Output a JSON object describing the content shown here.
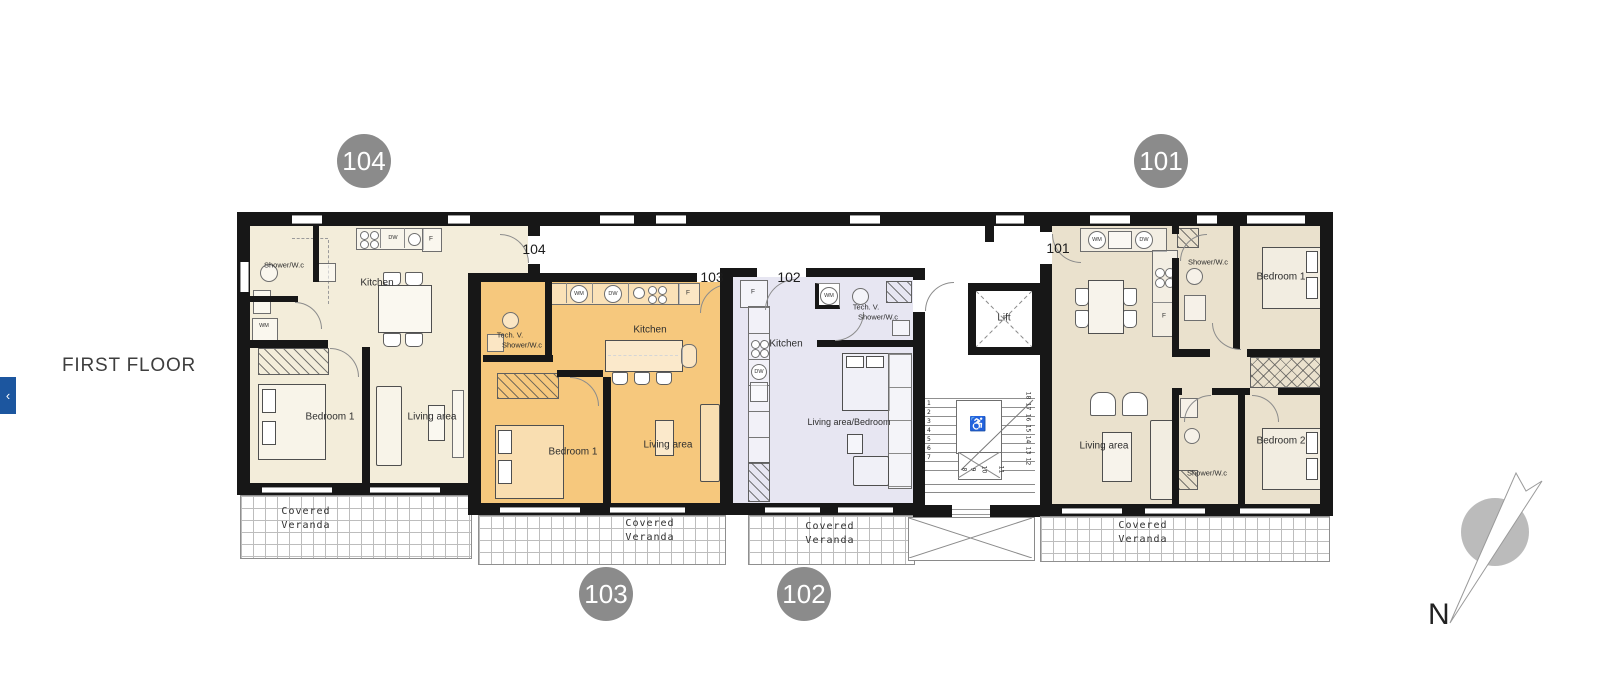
{
  "header": {
    "floor_title": "FIRST FLOOR"
  },
  "nav": {
    "back_chevron": "‹"
  },
  "badges": {
    "apt104": "104",
    "apt101": "101",
    "apt103": "103",
    "apt102": "102"
  },
  "compass": {
    "north_label": "N"
  },
  "colors": {
    "apt104_fill": "#f3edda",
    "apt103_fill": "#f6c87d",
    "apt102_fill": "#e7e6f2",
    "apt101_fill": "#eae1cd",
    "badge_gray": "#8b8b8b",
    "accent_blue": "#1c569f",
    "wall_black": "#171717",
    "compass_gray": "#b4b4b4"
  },
  "apt104": {
    "door_label": "104",
    "shower_wc": "Shower/W.c",
    "wm": "WM",
    "kitchen": "Kitchen",
    "dw": "DW",
    "fridge": "F",
    "bedroom1": "Bedroom 1",
    "living": "Living area",
    "veranda_line1": "Covered",
    "veranda_line2": "Veranda"
  },
  "apt103": {
    "corner_label": "103",
    "tech": "Tech. V.",
    "shower_wc": "Shower/W.c",
    "wm": "WM",
    "dw": "DW",
    "fridge": "F",
    "kitchen": "Kitchen",
    "bedroom1": "Bedroom 1",
    "living": "Living area",
    "veranda_line1": "Covered",
    "veranda_line2": "Veranda"
  },
  "apt102": {
    "corner_label": "102",
    "fridge": "F",
    "wm": "WM",
    "tech": "Tech. V.",
    "shower_wc": "Shower/W.c",
    "kitchen": "Kitchen",
    "dw": "DW",
    "living": "Living area/Bedroom",
    "veranda_line1": "Covered",
    "veranda_line2": "Veranda"
  },
  "apt101": {
    "door_label": "101",
    "wm": "WM",
    "dw": "DW",
    "fridge": "F",
    "shower_wc_top": "Shower/W.c",
    "bedroom1": "Bedroom 1",
    "living": "Living area",
    "shower_wc_bottom": "Shower/W.c",
    "bedroom2": "Bedroom 2",
    "veranda_line1": "Covered",
    "veranda_line2": "Veranda"
  },
  "core": {
    "lift": "Lift",
    "wheelchair": "♿",
    "stairs_left": [
      "1",
      "2",
      "3",
      "4",
      "5",
      "6",
      "7"
    ],
    "stairs_bottom": [
      "8",
      "9",
      "10",
      "11"
    ],
    "stairs_right": [
      "18",
      "17",
      "16",
      "15",
      "14",
      "13",
      "12"
    ]
  }
}
